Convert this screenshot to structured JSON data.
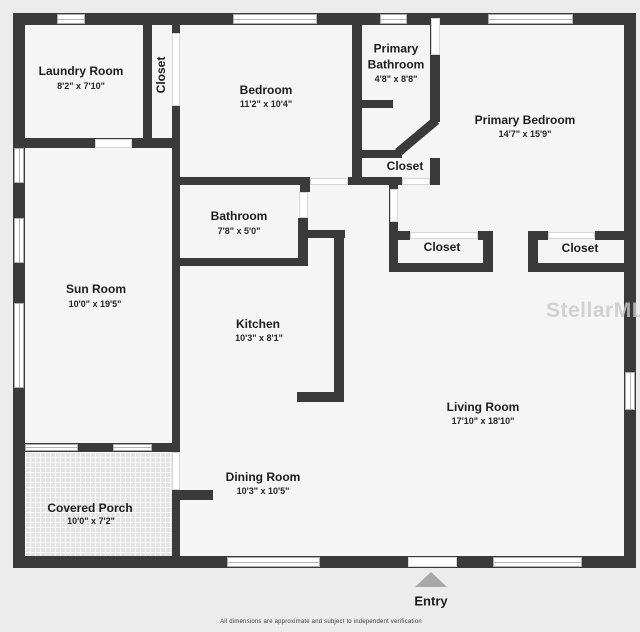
{
  "rooms": {
    "laundry": {
      "name": "Laundry Room",
      "dims": "8'2\" x 7'10\""
    },
    "bedroom_closet": {
      "name": "Closet"
    },
    "bedroom": {
      "name": "Bedroom",
      "dims": "11'2\" x 10'4\""
    },
    "primary_bathroom": {
      "name": "Primary Bathroom",
      "dims": "4'8\" x 8'8\""
    },
    "primary_bath_closet": {
      "name": "Closet"
    },
    "primary_bedroom": {
      "name": "Primary Bedroom",
      "dims": "14'7\" x 15'9\""
    },
    "bathroom": {
      "name": "Bathroom",
      "dims": "7'8\" x 5'0\""
    },
    "sun_room": {
      "name": "Sun Room",
      "dims": "10'0\" x 19'5\""
    },
    "kitchen": {
      "name": "Kitchen",
      "dims": "10'3\" x 8'1\""
    },
    "closet_left": {
      "name": "Closet"
    },
    "closet_right": {
      "name": "Closet"
    },
    "living_room": {
      "name": "Living Room",
      "dims": "17'10\" x 18'10\""
    },
    "dining_room": {
      "name": "Dining Room",
      "dims": "10'3\" x 10'5\""
    },
    "covered_porch": {
      "name": "Covered Porch",
      "dims": "10'0\" x 7'2\""
    }
  },
  "entry": {
    "label": "Entry"
  },
  "watermark": "StellarMLS",
  "disclaimer": "All dimensions are approximate and subject to independent verification",
  "colors": {
    "wall": "#3a3a3a",
    "floor": "#f5f5f5",
    "background": "#ececec",
    "entry_arrow": "#a8a8a8",
    "watermark": "#c9c9c9"
  }
}
